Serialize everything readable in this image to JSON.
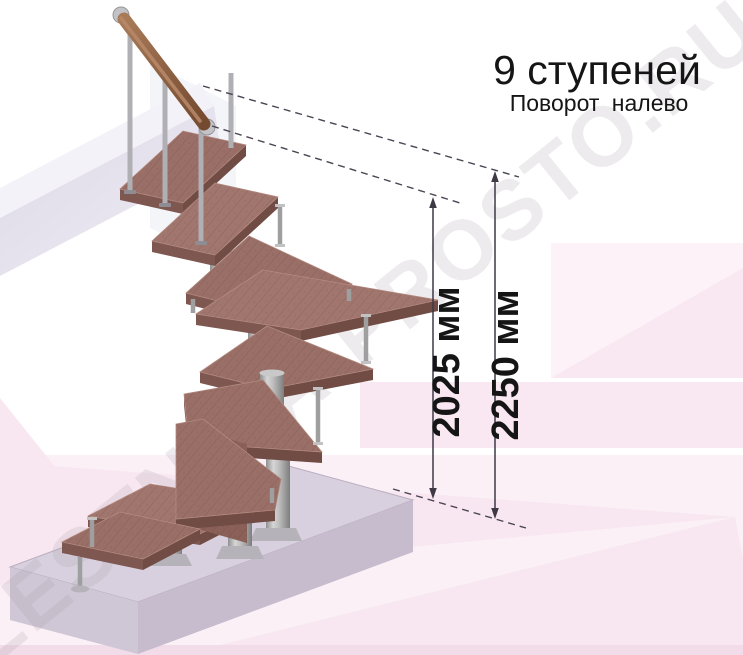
{
  "title": {
    "heading": "9 ступеней",
    "subheading": "Поворот налево"
  },
  "dimensions": {
    "inner": {
      "label": "2025 мм",
      "value_mm": 2025
    },
    "outer": {
      "label": "2250 мм",
      "value_mm": 2250
    }
  },
  "watermark": {
    "text": "LESTNICA-PROSTO.RU"
  },
  "stairs": {
    "step_count": 9,
    "turn_direction": "налево"
  },
  "colors": {
    "step_wood": "#9a6f67",
    "step_wood_edge": "#704c44",
    "handrail_wood": "#8a5a3e",
    "metal": "#a9a9a9",
    "floor_slab": "#d8d0de",
    "background_pink": "#f9e8f1",
    "dimension_line": "#45404d",
    "text": "#151515"
  }
}
